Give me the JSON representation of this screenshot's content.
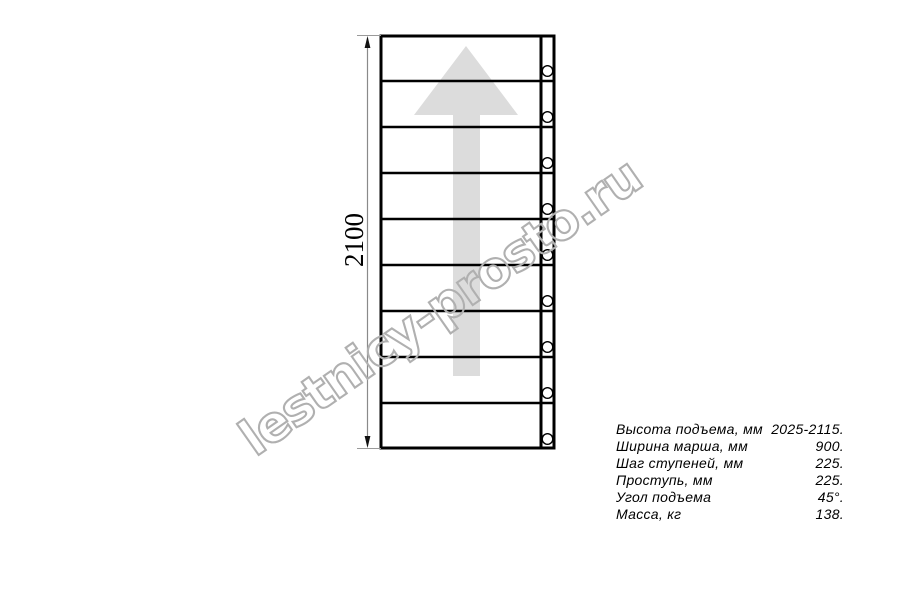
{
  "drawing": {
    "dimension_height_label": "2100",
    "watermark_text": "lestnicy-prosto.ru",
    "steps_count": 9,
    "fastener_holes_count": 9
  },
  "specs": {
    "rows": [
      {
        "label": "Высота подъема, мм",
        "value": "2025-2115."
      },
      {
        "label": "Ширина марша, мм",
        "value": "900."
      },
      {
        "label": "Шаг ступеней, мм",
        "value": "225."
      },
      {
        "label": "Проступь, мм",
        "value": "225."
      },
      {
        "label": "Угол подъема",
        "value": "45°."
      },
      {
        "label": "Масса, кг",
        "value": "138."
      }
    ]
  },
  "colors": {
    "outline": "#000000",
    "arrow_fill": "#dcdcdc",
    "watermark_stroke": "#b0b0b0",
    "dimension_line": "#8a8a8a"
  }
}
